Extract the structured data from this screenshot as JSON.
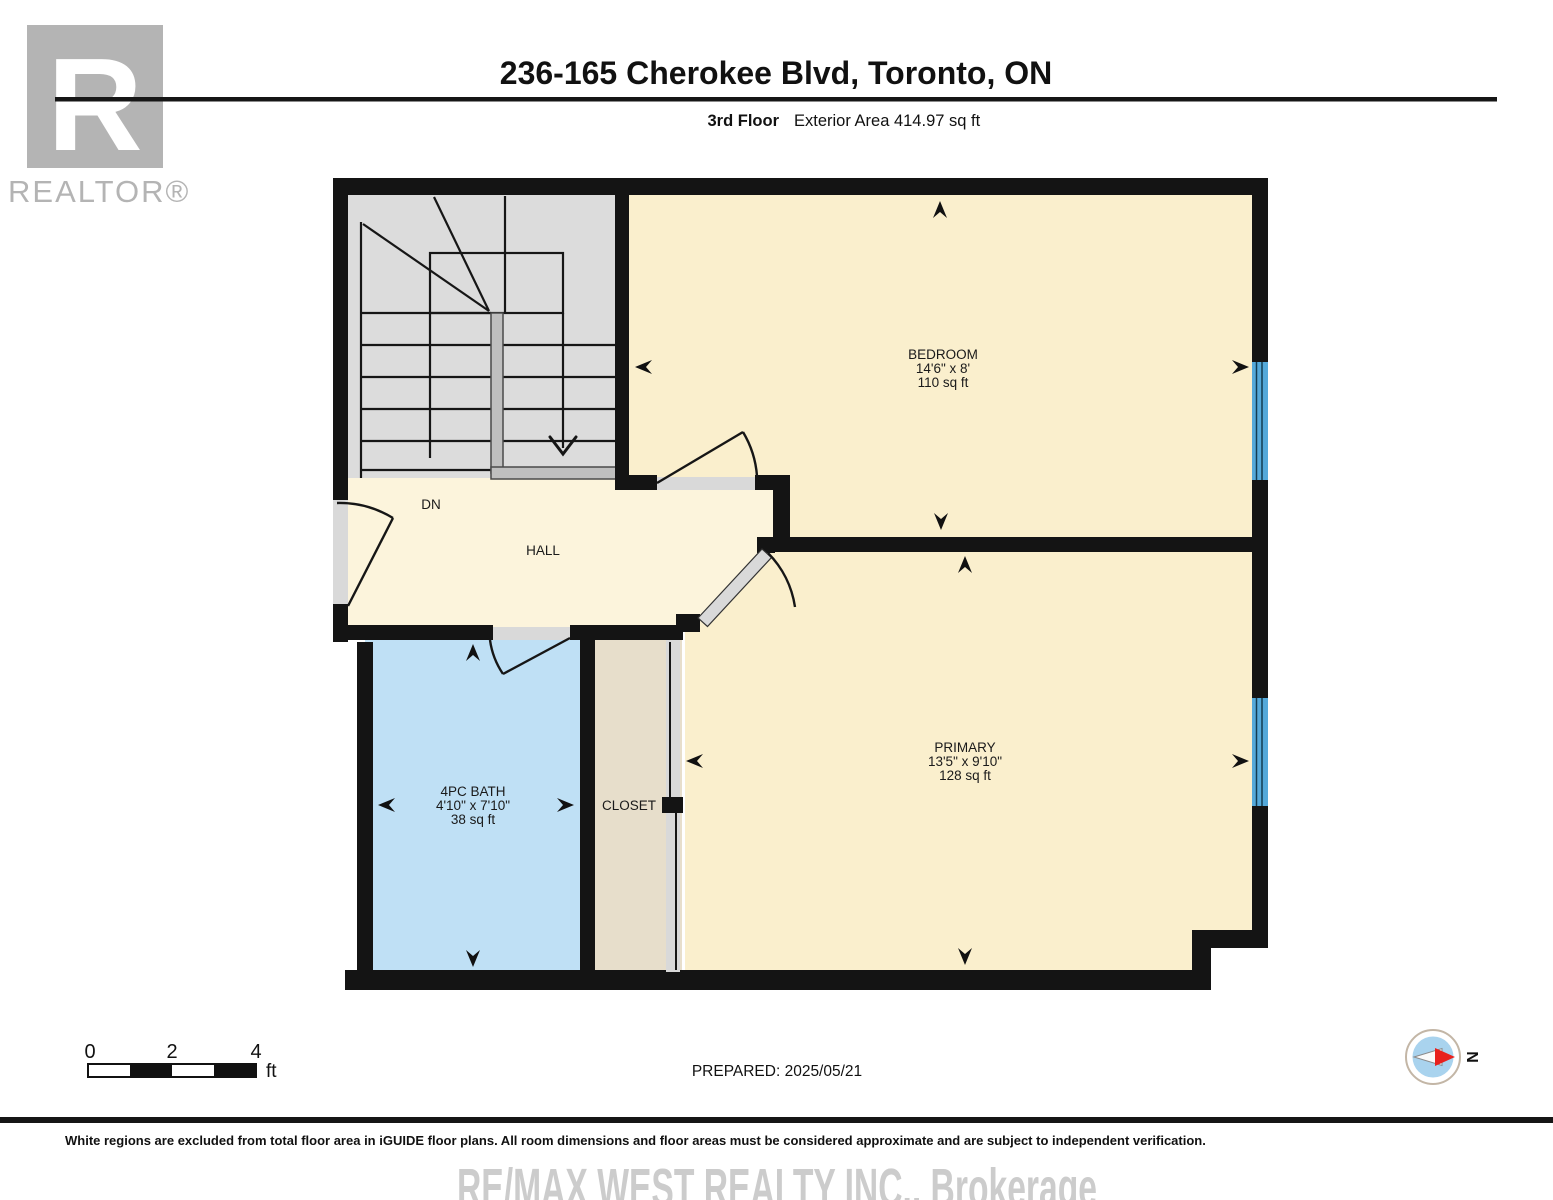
{
  "header": {
    "title": "236-165 Cherokee Blvd, Toronto, ON",
    "floor_label": "3rd Floor",
    "area_label": "Exterior Area 414.97 sq ft"
  },
  "logo": {
    "letter": "R",
    "label": "REALTOR®"
  },
  "rooms": {
    "bedroom": {
      "name": "BEDROOM",
      "dims": "14'6\" x 8'",
      "area": "110 sq ft"
    },
    "primary": {
      "name": "PRIMARY",
      "dims": "13'5\" x 9'10\"",
      "area": "128 sq ft"
    },
    "bath": {
      "name": "4PC BATH",
      "dims": "4'10\" x 7'10\"",
      "area": "38 sq ft"
    },
    "closet": {
      "name": "CLOSET"
    },
    "hall": {
      "name": "HALL"
    },
    "stairs": {
      "direction_label": "DN"
    }
  },
  "scale_bar": {
    "tick_0": "0",
    "tick_2": "2",
    "tick_4": "4",
    "unit": "ft"
  },
  "compass": {
    "north_label": "N"
  },
  "footer": {
    "prepared": "PREPARED: 2025/05/21",
    "disclaimer": "White regions are excluded from total floor area in iGUIDE floor plans. All room dimensions and floor areas must be considered approximate and are subject to independent verification.",
    "watermark": "RE/MAX WEST REALTY INC., Brokerage"
  },
  "colors": {
    "wall": "#141414",
    "room_cream": "#faefcd",
    "hall_cream": "#fcf4dc",
    "bath_blue": "#bfe0f5",
    "closet_beige": "#e7decb",
    "stairs_gray": "#dcdcdc",
    "door_gray": "#d9d9d9",
    "window_blue": "#54a9da",
    "logo_gray": "#b4b4b4",
    "watermark_gray": "#cccccc"
  }
}
